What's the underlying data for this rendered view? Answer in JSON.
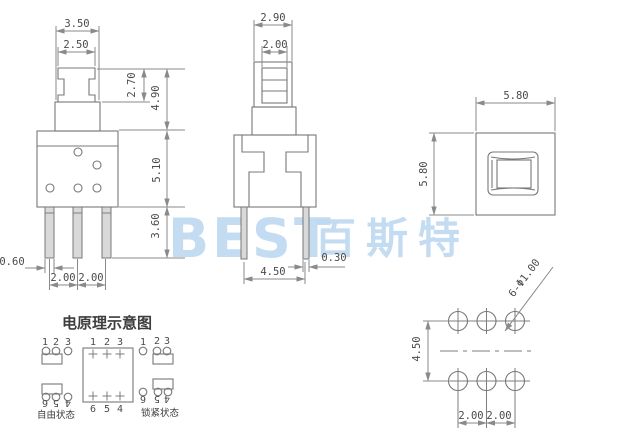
{
  "watermark": {
    "latin": "BEST",
    "cjk": "百斯特"
  },
  "front_view": {
    "dim_top_width": "3.50",
    "dim_cap_width": "2.50",
    "dim_cap_height": "2.70",
    "dim_upper_height": "4.90",
    "dim_body_height": "5.10",
    "dim_leg_length": "3.60",
    "dim_leg_width": "0.60",
    "dim_pitch_a": "2.00",
    "dim_pitch_b": "2.00"
  },
  "side_view": {
    "dim_cap_depth": "2.90",
    "dim_plunger_depth": "2.00",
    "dim_leg_thickness": "0.30",
    "dim_leg_span": "4.50"
  },
  "top_view": {
    "dim_width": "5.80",
    "dim_height": "5.80"
  },
  "hole_layout": {
    "dim_row_pitch": "4.50",
    "dim_col_pitch_a": "2.00",
    "dim_col_pitch_b": "2.00",
    "hole_callout": "6-Φ1.00"
  },
  "schematic": {
    "title": "电原理示意图",
    "free_state": {
      "label": "自由状态",
      "top_pins": [
        "1",
        "2",
        "3"
      ],
      "bottom_pins": [
        "6",
        "5",
        "4"
      ]
    },
    "switch_box": {
      "top_pins": [
        "1",
        "2",
        "3"
      ],
      "bottom_pins": [
        "6",
        "5",
        "4"
      ]
    },
    "locked_state": {
      "label": "锁紧状态",
      "top_pins": [
        "1",
        "2",
        "3"
      ],
      "bottom_pins": [
        "6",
        "5",
        "4"
      ]
    }
  },
  "colors": {
    "line": "#7d7d7d",
    "dim_text": "#4a4a4a",
    "watermark": "#bed9f0",
    "background": "#ffffff"
  }
}
